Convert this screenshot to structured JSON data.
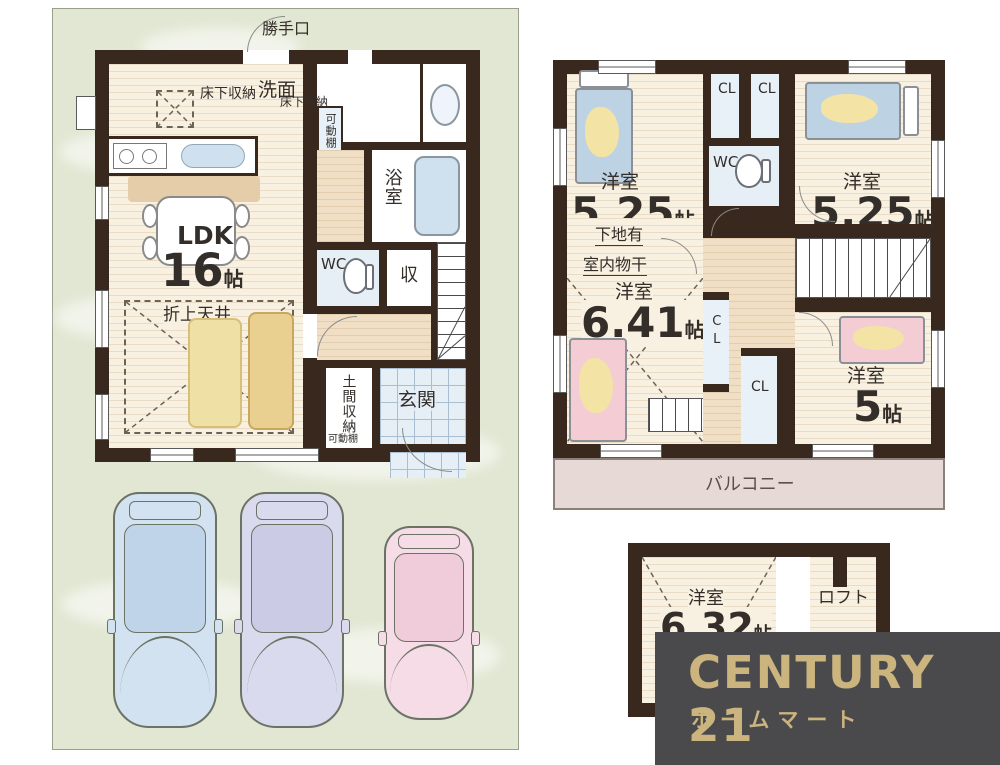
{
  "logo": {
    "brand": "CENTURY 21",
    "store": "ホームマート"
  },
  "colors": {
    "wall": "#38281e",
    "floor_cream": "#f8f0e0",
    "hall_floor": "#f0dfc5",
    "panel_green": "#e2e7d3",
    "tile_blue": "#e7eff6",
    "closet_blue": "#e8f1f7",
    "balcony_pink": "#e6d9d6",
    "bed_blue": "#bdd3e4",
    "bed_pink": "#f4cdd4",
    "bed_yellow": "#f3e3a4",
    "logo_bg": "#4a4a4d",
    "logo_gold": "#cbb47e",
    "car_blue": "#d3e2f1",
    "car_lavender": "#dadaee",
    "car_pink": "#f5dce6"
  },
  "floor1": {
    "back_door": "勝手口",
    "underfloor_storage_kitchen": "床下収納",
    "underfloor_storage_wash": "床下収納",
    "movable_shelf_pantry": "可動棚",
    "movable_shelf_doma": "可動棚",
    "washroom": "洗面",
    "bathroom": "浴室",
    "ldk_name": "LDK",
    "ldk_size": "16",
    "ldk_unit": "帖",
    "wc": "WC",
    "storage": "収",
    "raised_ceiling": "折上天井",
    "doma_storage": "土間収納",
    "entrance": "玄関"
  },
  "floor2": {
    "room_tl": {
      "name": "洋室",
      "size": "5.25",
      "unit": "帖"
    },
    "room_tr": {
      "name": "洋室",
      "size": "5.25",
      "unit": "帖"
    },
    "cl_top_1": "CL",
    "cl_top_2": "CL",
    "wc": "WC",
    "note_line1": "下地有",
    "note_line2": "室内物干",
    "room_bl": {
      "name": "洋室",
      "size": "6.41",
      "unit": "帖"
    },
    "cl_mid": "CL",
    "cl_low": "CL",
    "room_br": {
      "name": "洋室",
      "size": "5",
      "unit": "帖"
    },
    "balcony": "バルコニー"
  },
  "loft": {
    "room": {
      "name": "洋室",
      "size": "6.32",
      "unit": "帖"
    },
    "label": "ロフト"
  }
}
